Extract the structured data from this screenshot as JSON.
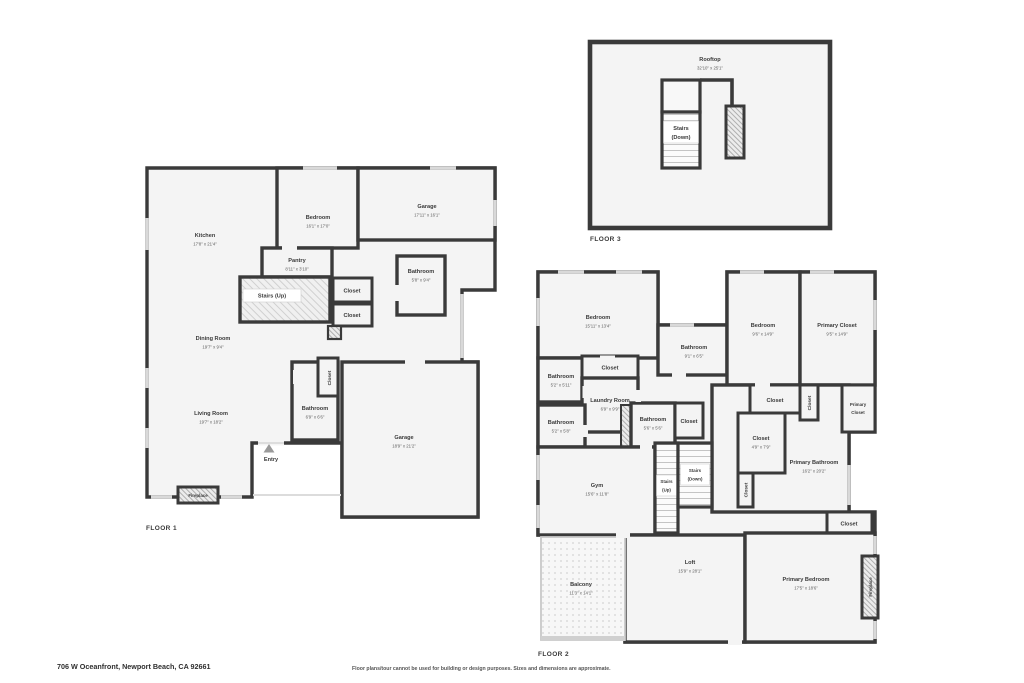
{
  "meta": {
    "address": "706 W Oceanfront, Newport Beach, CA 92661",
    "disclaimer": "Floor plans/tour cannot be used for building or design purposes. Sizes and dimensions are approximate."
  },
  "colors": {
    "wall": "#3a3a3a",
    "room_fill": "#f4f4f4",
    "window": "#d9d9d9",
    "background": "#ffffff"
  },
  "floor1": {
    "label": "FLOOR 1",
    "rooms": {
      "kitchen": {
        "name": "Kitchen",
        "dims": "17'8\" x 21'4\""
      },
      "bedroom": {
        "name": "Bedroom",
        "dims": "16'1\" x 17'0\""
      },
      "garage_upper": {
        "name": "Garage",
        "dims": "17'11\" x 16'1\""
      },
      "pantry": {
        "name": "Pantry",
        "dims": "8'11\" x 3'10\""
      },
      "stairs_up": {
        "name": "Stairs (Up)"
      },
      "closet_1": {
        "name": "Closet"
      },
      "closet_2": {
        "name": "Closet"
      },
      "bathroom_upper": {
        "name": "Bathroom",
        "dims": "5'8\" x 9'4\""
      },
      "dining_room": {
        "name": "Dining Room",
        "dims": "19'7\" x 9'4\""
      },
      "living_room": {
        "name": "Living Room",
        "dims": "19'7\" x 18'2\""
      },
      "closet_3": {
        "name": "Closet"
      },
      "bathroom_lower": {
        "name": "Bathroom",
        "dims": "6'9\" x 6'6\""
      },
      "garage_lower": {
        "name": "Garage",
        "dims": "18'9\" x 21'2\""
      },
      "entry": {
        "name": "Entry"
      },
      "fireplace": {
        "name": "Fireplace"
      }
    }
  },
  "floor2": {
    "label": "FLOOR 2",
    "rooms": {
      "bedroom_1": {
        "name": "Bedroom",
        "dims": "15'11\" x 13'4\""
      },
      "bathroom_1": {
        "name": "Bathroom",
        "dims": "9'1\" x 6'5\""
      },
      "bedroom_2": {
        "name": "Bedroom",
        "dims": "9'6\" x 14'9\""
      },
      "primary_closet_1": {
        "name": "Primary Closet",
        "dims": "9'5\" x 14'9\""
      },
      "bathroom_2": {
        "name": "Bathroom",
        "dims": "5'2\" x 5'11\""
      },
      "closet_1": {
        "name": "Closet"
      },
      "laundry_room": {
        "name": "Laundry Room",
        "dims": "6'9\" x 9'9\""
      },
      "bathroom_3": {
        "name": "Bathroom",
        "dims": "5'2\" x 5'8\""
      },
      "bathroom_4": {
        "name": "Bathroom",
        "dims": "5'6\" x 5'6\""
      },
      "closet_2": {
        "name": "Closet"
      },
      "stairs_up": {
        "name": "Stairs",
        "direction": "(Up)"
      },
      "stairs_down": {
        "name": "Stairs",
        "direction": "(Down)"
      },
      "gym": {
        "name": "Gym",
        "dims": "15'6\" x 11'8\""
      },
      "closet_3": {
        "name": "Closet",
        "dims": "4'9\" x 7'9\""
      },
      "closet_4": {
        "name": "Closet"
      },
      "closet_5": {
        "name": "Closet"
      },
      "closet_6": {
        "name": "Closet"
      },
      "primary_closet_2": {
        "line1": "Primary",
        "line2": "Closet"
      },
      "primary_bathroom": {
        "name": "Primary Bathroom",
        "dims": "16'2\" x 20'2\""
      },
      "closet_7": {
        "name": "Closet"
      },
      "balcony": {
        "name": "Balcony",
        "dims": "11'3\" x 14'1\""
      },
      "loft": {
        "name": "Loft",
        "dims": "15'9\" x 28'1\""
      },
      "primary_bedroom": {
        "name": "Primary Bedroom",
        "dims": "17'5\" x 18'6\""
      },
      "fireplace": {
        "name": "Fireplace"
      }
    }
  },
  "floor3": {
    "label": "FLOOR 3",
    "rooms": {
      "rooftop": {
        "name": "Rooftop",
        "dims": "32'10\" x 25'1\""
      },
      "stairs_down": {
        "name": "Stairs",
        "direction": "(Down)"
      }
    }
  }
}
